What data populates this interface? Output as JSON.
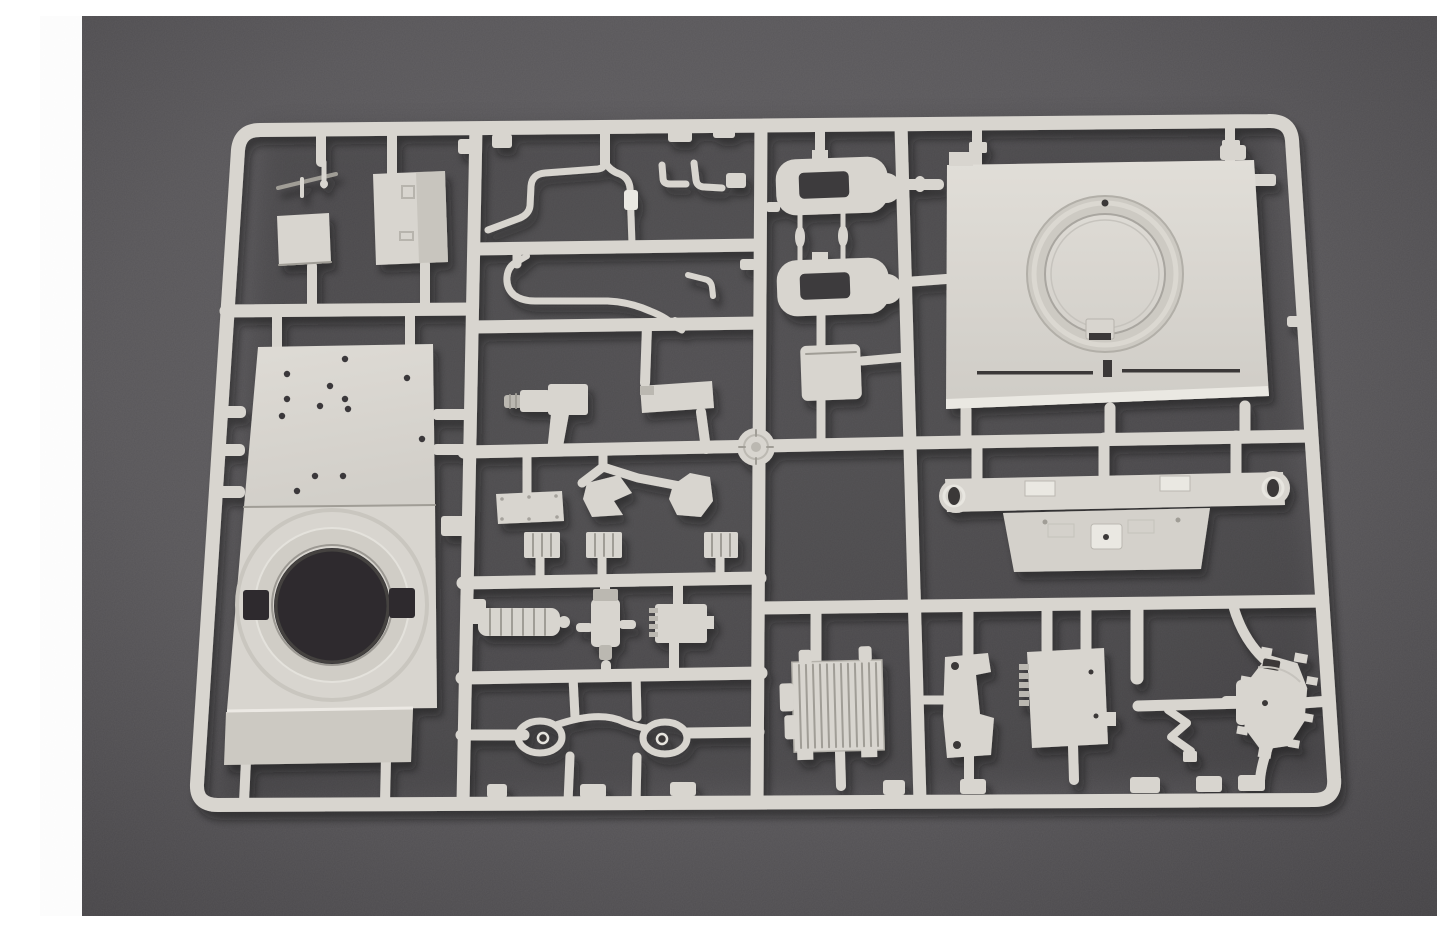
{
  "image": {
    "type": "photograph",
    "description": "Light gray injection-molded plastic model kit sprue (parts tree) for an armored vehicle kit, lying on a dark gray textured surface, with white vertical margins at the left and right edges of the photo",
    "orientation": "landscape"
  },
  "colors": {
    "page_margin": "#fdfdfd",
    "background": "#595759",
    "background_edge": "#4a484b",
    "plastic": "#d8d5cf",
    "plastic_highlight": "#eae8e2",
    "plastic_shadow": "#bbb8b1",
    "plastic_dark": "#a09d96",
    "hole_dark": "#2d2c2e",
    "slot_dark": "#3a3937",
    "cavity": "#3c3b3d",
    "edge_sliver": "#cfcfd2"
  },
  "sprue": {
    "material": "light gray styrene",
    "frame": "rounded rectangular outer runner with an internal grid of runners and sprue gates",
    "parts": [
      {
        "name": "wire-antenna-piece",
        "location": "top left cell"
      },
      {
        "name": "small-square-panel",
        "location": "top left cell"
      },
      {
        "name": "rectangular-hatch-box",
        "location": "top left cell"
      },
      {
        "name": "hull-roof-plate-with-turret-ring-opening",
        "location": "left column, large part with many small holes and big circular cutout"
      },
      {
        "name": "bent-fuel-line-1",
        "location": "upper middle cell"
      },
      {
        "name": "bent-fuel-line-2",
        "location": "middle cell below first pipe"
      },
      {
        "name": "pipe-elbow-fittings",
        "location": "upper middle, right side of pipe cells"
      },
      {
        "name": "periscope-cylinder",
        "location": "middle column"
      },
      {
        "name": "equipment-bar",
        "location": "middle column"
      },
      {
        "name": "sprue-gate-disc",
        "location": "runner junction at center"
      },
      {
        "name": "riveted-access-plate",
        "location": "center cell"
      },
      {
        "name": "wedge-bracket-left",
        "location": "center cell"
      },
      {
        "name": "wedge-bracket-right",
        "location": "center cell"
      },
      {
        "name": "three-ribbed-blocks",
        "location": "center cell above rail"
      },
      {
        "name": "ribbed-muffler-cylinder",
        "location": "center lower row"
      },
      {
        "name": "valve-body-with-side-arms",
        "location": "center lower row"
      },
      {
        "name": "comb-edged-small-box",
        "location": "center lower row"
      },
      {
        "name": "tow-cable-with-loop-ends",
        "location": "bottom middle cell"
      },
      {
        "name": "hatch-frame-ring-upper",
        "location": "middle right column"
      },
      {
        "name": "hatch-frame-ring-lower",
        "location": "middle right column"
      },
      {
        "name": "two-connecting-rods",
        "location": "between hatch frame rings"
      },
      {
        "name": "small-equipment-box",
        "location": "middle right column"
      },
      {
        "name": "turret-roof-plate-with-hatch-ring",
        "location": "large part, upper right"
      },
      {
        "name": "mounting-beam-with-loop-ends",
        "location": "right, below turret plate"
      },
      {
        "name": "mounting-plate-with-center-boss",
        "location": "right, below beam"
      },
      {
        "name": "radiator-grille-box",
        "location": "lower right row"
      },
      {
        "name": "stepped-bracket",
        "location": "lower right row"
      },
      {
        "name": "ribbed-edge-equipment-box",
        "location": "lower right row"
      },
      {
        "name": "zigzag-bracket",
        "location": "lower right row"
      },
      {
        "name": "cross-handle",
        "location": "lower right row"
      },
      {
        "name": "oval-bolted-hatch",
        "location": "bottom right corner"
      }
    ]
  }
}
